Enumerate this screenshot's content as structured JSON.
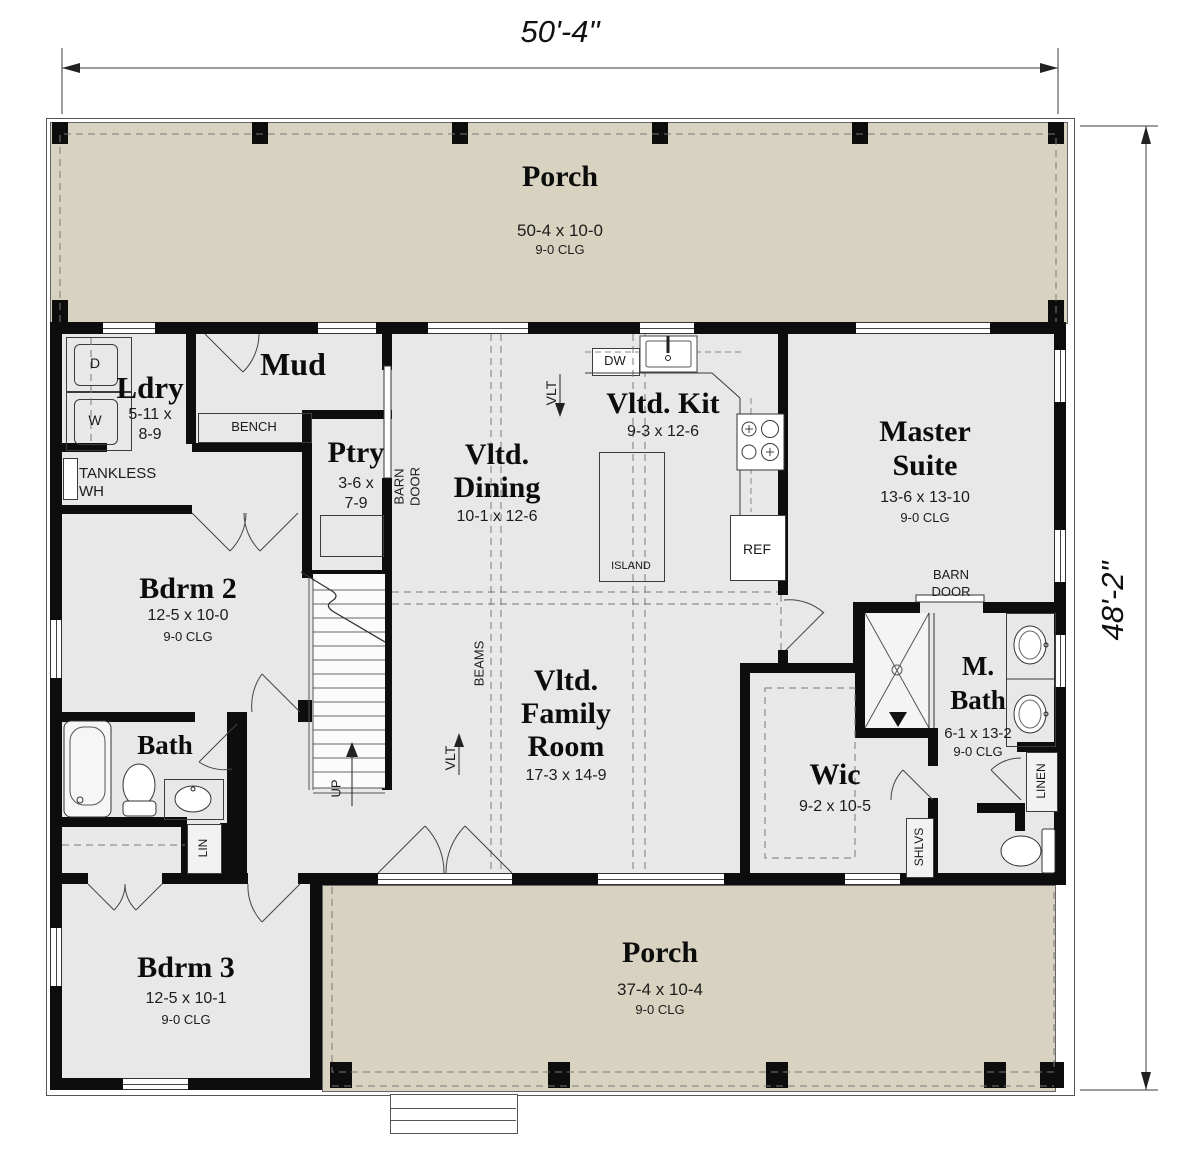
{
  "dimensions": {
    "width": "50'-4\"",
    "height": "48'-2\""
  },
  "rooms": {
    "porch_top": {
      "name": "Porch",
      "size": "50-4 x 10-0",
      "clg": "9-0 CLG"
    },
    "ldry": {
      "name": "Ldry",
      "size1": "5-11 x",
      "size2": "8-9"
    },
    "mud": {
      "name": "Mud"
    },
    "ptry": {
      "name": "Ptry",
      "size1": "3-6 x",
      "size2": "7-9"
    },
    "dining": {
      "name1": "Vltd.",
      "name2": "Dining",
      "size": "10-1 x 12-6"
    },
    "kitchen": {
      "name": "Vltd. Kit",
      "size": "9-3 x 12-6"
    },
    "master": {
      "name1": "Master",
      "name2": "Suite",
      "size": "13-6 x 13-10",
      "clg": "9-0 CLG"
    },
    "bdrm2": {
      "name": "Bdrm 2",
      "size": "12-5 x 10-0",
      "clg": "9-0 CLG"
    },
    "bath": {
      "name": "Bath"
    },
    "family": {
      "name1": "Vltd.",
      "name2": "Family",
      "name3": "Room",
      "size": "17-3 x 14-9"
    },
    "wic": {
      "name": "Wic",
      "size": "9-2 x 10-5"
    },
    "mbath": {
      "name1": "M.",
      "name2": "Bath",
      "size": "6-1 x 13-2",
      "clg": "9-0 CLG"
    },
    "bdrm3": {
      "name": "Bdrm 3",
      "size": "12-5 x 10-1",
      "clg": "9-0 CLG"
    },
    "porch_bottom": {
      "name": "Porch",
      "size": "37-4 x 10-4",
      "clg": "9-0 CLG"
    }
  },
  "labels": {
    "bench": "BENCH",
    "tankless1": "TANKLESS",
    "tankless2": "WH",
    "barn1": "BARN",
    "barn2": "DOOR",
    "dw": "DW",
    "island": "ISLAND",
    "ref": "REF",
    "vlt": "VLT",
    "beams": "BEAMS",
    "up": "UP",
    "lin": "LIN",
    "linen": "LINEN",
    "shlvs": "SHLVS",
    "dryer": "D",
    "washer": "W"
  },
  "colors": {
    "porch": "#d8d3c1",
    "floor": "#e8e8e8",
    "wall": "#0d0d0d"
  }
}
